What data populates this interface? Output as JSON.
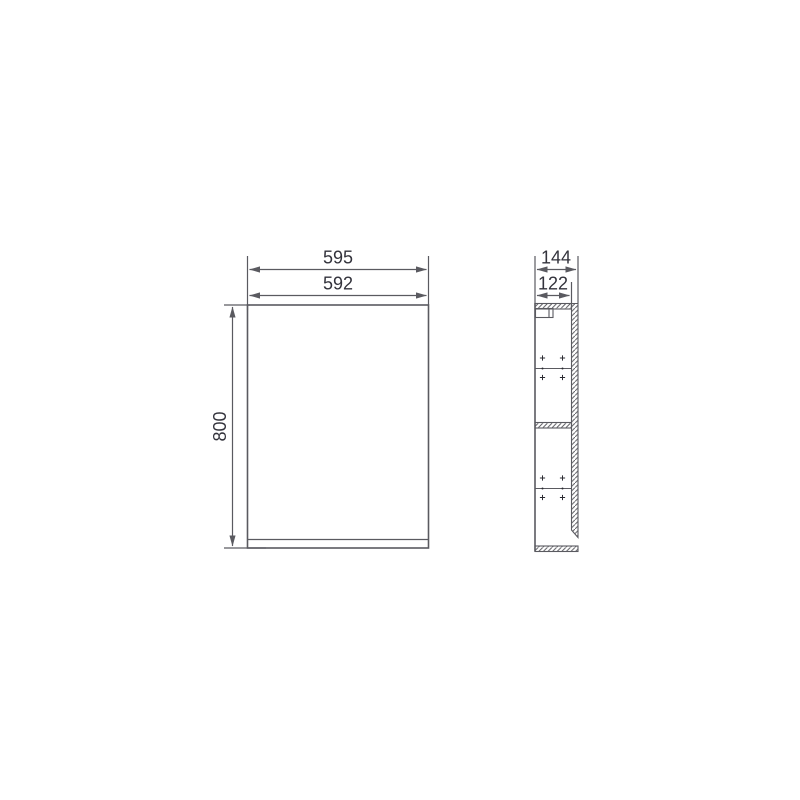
{
  "colors": {
    "background": "#ffffff",
    "line": "#5a5a60",
    "text": "#33333c"
  },
  "views": {
    "front": {
      "overall_width_label": "595",
      "door_width_label": "592",
      "height_label": "800"
    },
    "side": {
      "overall_depth_label": "144",
      "body_depth_label": "122"
    }
  }
}
